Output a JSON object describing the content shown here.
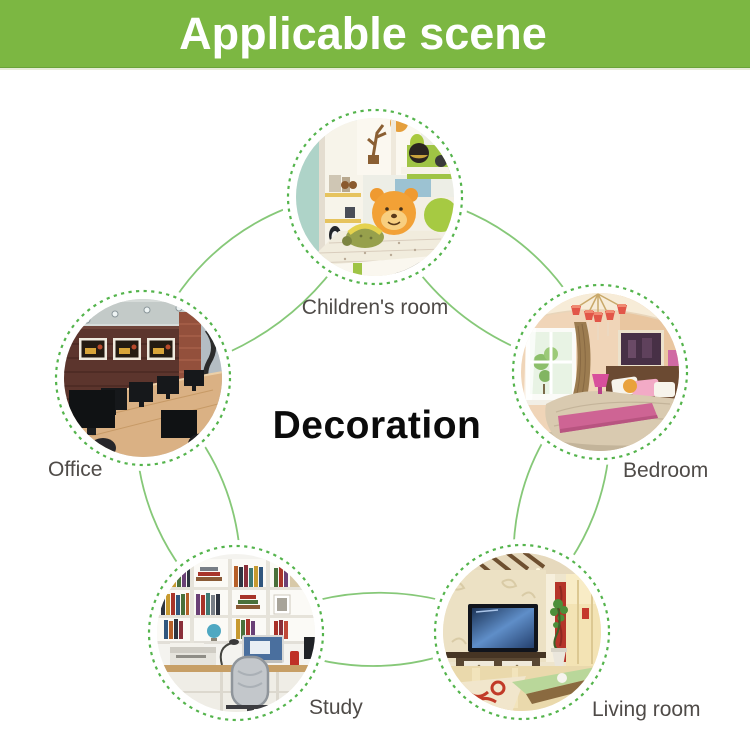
{
  "banner": {
    "title": "Applicable scene",
    "bg_color": "#7cb742",
    "text_color": "#ffffff"
  },
  "diagram": {
    "center_label": "Decoration",
    "scenes": [
      {
        "id": "children-room",
        "label": "Children's room",
        "position": "top"
      },
      {
        "id": "office",
        "label": "Office",
        "position": "left"
      },
      {
        "id": "bedroom",
        "label": "Bedroom",
        "position": "right"
      },
      {
        "id": "study",
        "label": "Study",
        "position": "bottom-left"
      },
      {
        "id": "living-room",
        "label": "Living room",
        "position": "bottom-right"
      }
    ],
    "colors": {
      "connector_line": "#86c878",
      "dashed_ring": "#54b44c",
      "label_text": "#4f4b48",
      "center_text": "#0b0b0b"
    }
  }
}
